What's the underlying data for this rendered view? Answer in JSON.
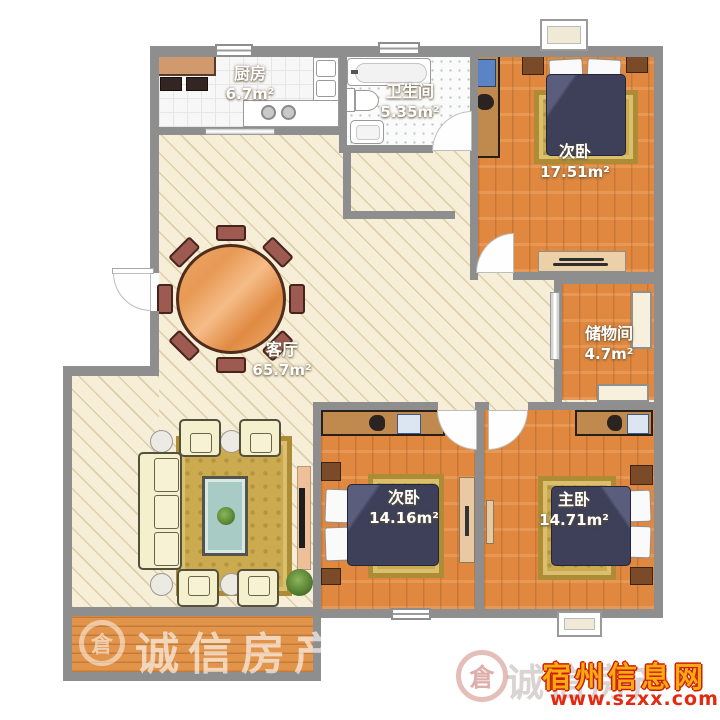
{
  "rooms": {
    "kitchen": {
      "name": "厨房",
      "area": "6.7m²"
    },
    "bathroom": {
      "name": "卫生间",
      "area": "5.35m²"
    },
    "bedroom_top": {
      "name": "次卧",
      "area": "17.51m²"
    },
    "storage": {
      "name": "储物间",
      "area": "4.7m²"
    },
    "living": {
      "name": "客厅",
      "area": "65.7m²"
    },
    "bedroom_mid": {
      "name": "次卧",
      "area": "14.16m²"
    },
    "master": {
      "name": "主卧",
      "area": "14.71m²"
    }
  },
  "watermarks": {
    "balcony_agency": "诚信房产",
    "corner_agency": "诚信房产",
    "site_name": "宿州信息网",
    "site_url": "www.szxx.com.cn",
    "logo_glyph": "倉"
  },
  "colors": {
    "wall": "#8e8e8e",
    "wood_floor": "#e0883f",
    "living_floor": "#f6eed6",
    "rug_gold": "#cbaa50",
    "bed_navy": "#3d4058",
    "site_name_color": "#f7aa13",
    "site_url_color": "#e32a10"
  }
}
